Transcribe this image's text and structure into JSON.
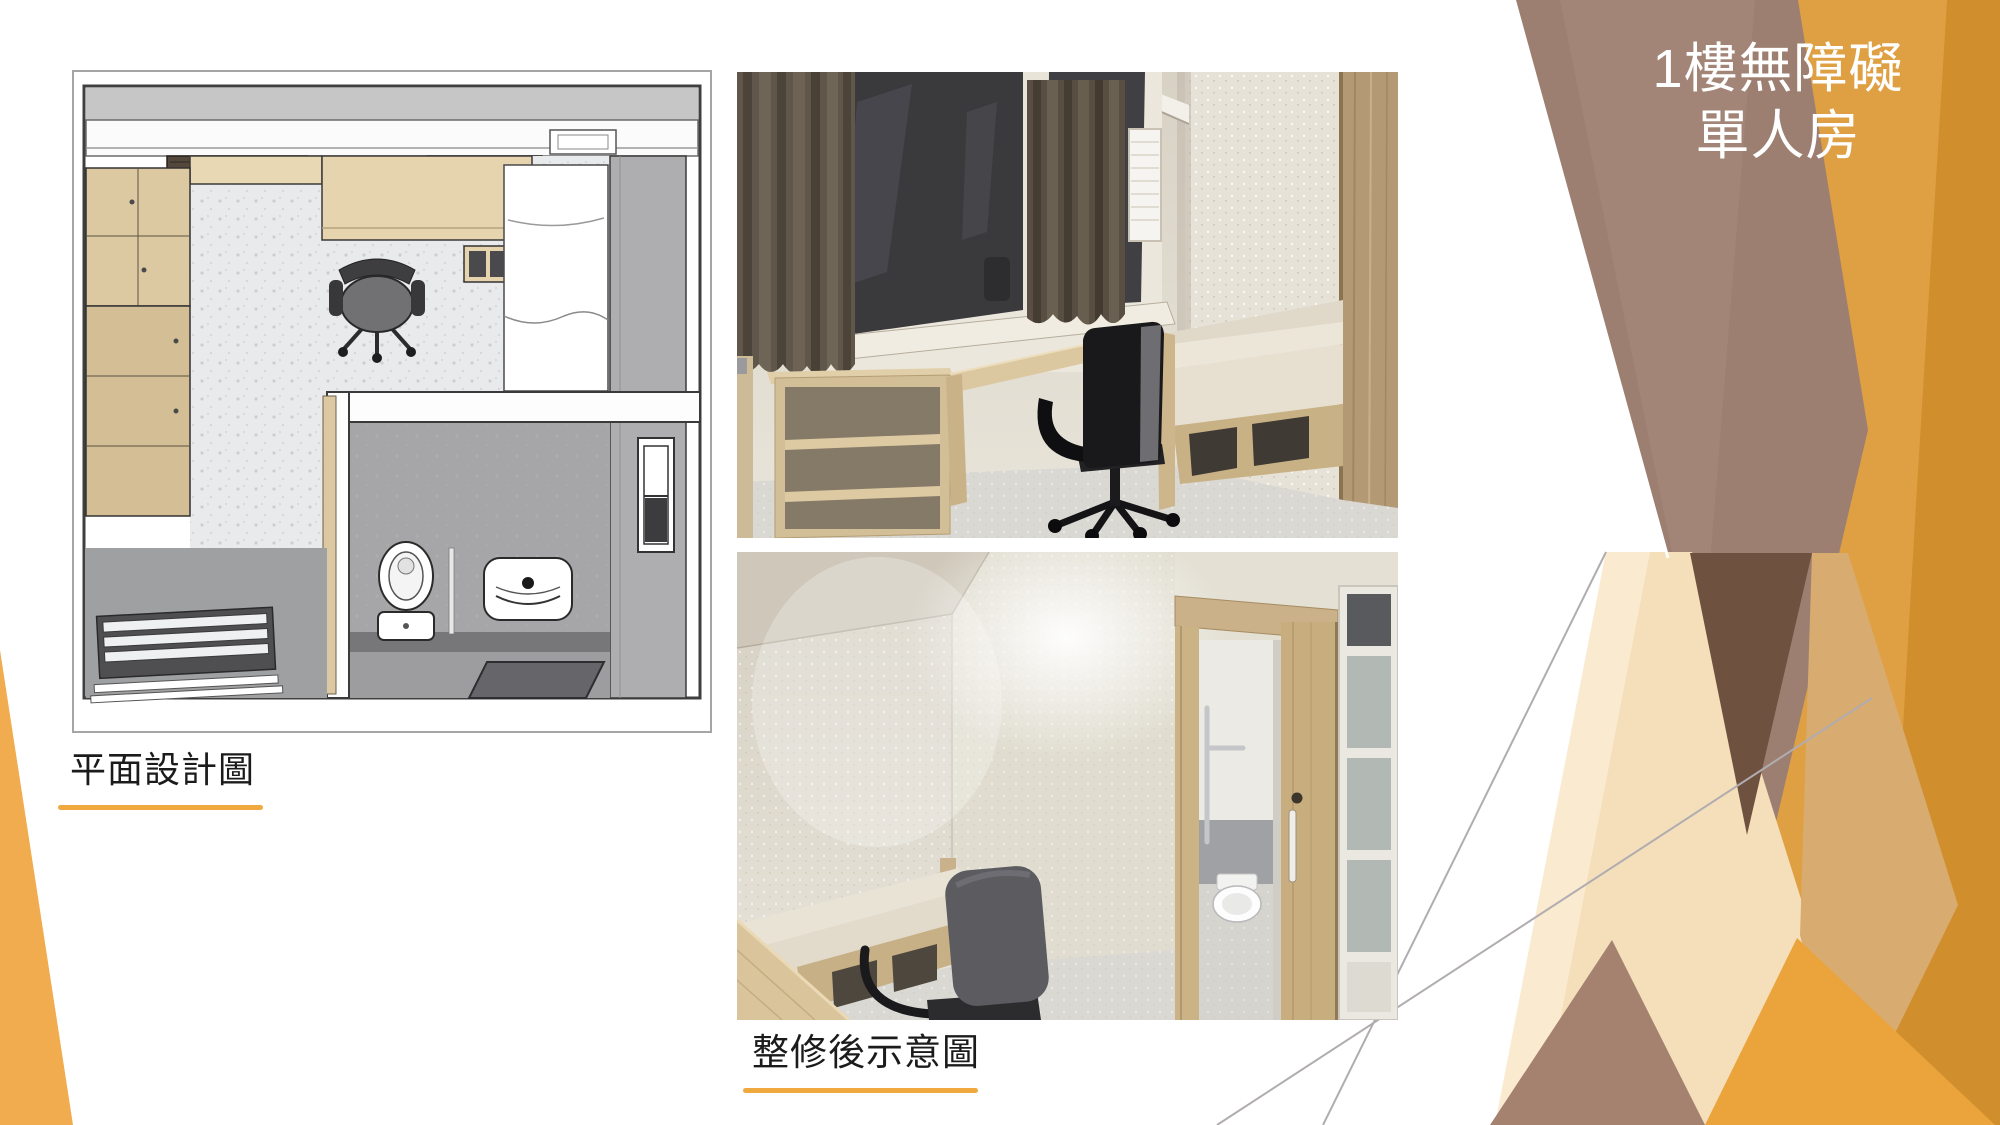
{
  "slide": {
    "title": {
      "line1": "1樓無障礙",
      "line2": "單人房"
    },
    "captions": {
      "floor_plan": "平面設計圖",
      "renovation": "整修後示意圖"
    },
    "colors": {
      "title_text": "#FFFFFF",
      "caption_text": "#1B1B1B",
      "caption_underline": "#EFA93F",
      "deco_orange": "#DFA044",
      "deco_orange_dark": "#D18E2D",
      "deco_orange_bright": "#EBA43C",
      "deco_brown": "#9D7F71",
      "deco_brown_dark": "#6F513F",
      "deco_mauve": "#A58170",
      "deco_tan": "#D8AB70",
      "deco_cream": "#F5DFBA",
      "deco_cream_light": "#FAEBD0",
      "corner_wedge_orange": "#F0AC4E",
      "hairline_gray": "#B0ACB0"
    }
  }
}
